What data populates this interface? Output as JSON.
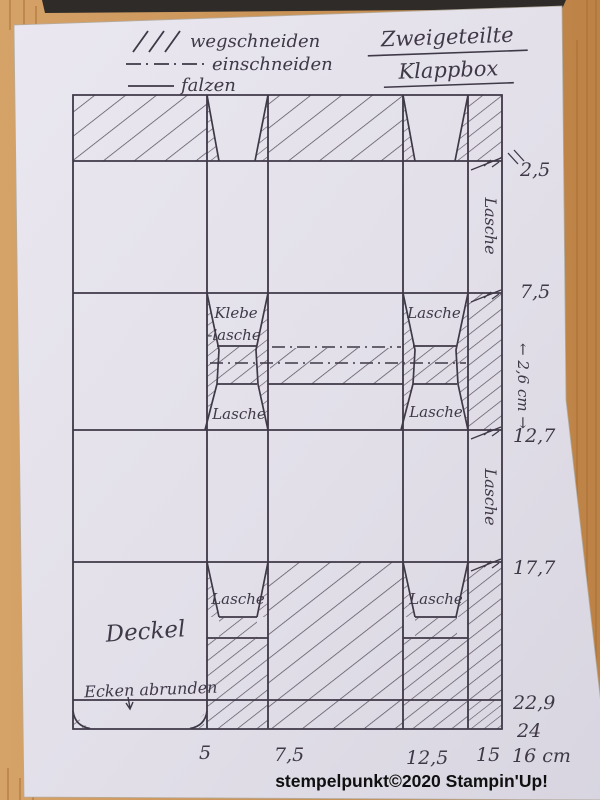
{
  "title": {
    "line1": "Zweigeteilte",
    "line2": "Klappbox"
  },
  "legend": {
    "items": [
      {
        "symbol": "hatch",
        "label": "wegschneiden"
      },
      {
        "symbol": "dash-dot",
        "label": "einschneiden"
      },
      {
        "symbol": "solid-line",
        "label": "falzen"
      }
    ]
  },
  "template": {
    "labels": {
      "klebe_line1": "Klebe",
      "klebe_line2": "-lasche",
      "lasche": "Lasche",
      "deckel": "Deckel",
      "round_corners": "Ecken abrunden",
      "slit_width_note": "← 2,6 cm →"
    },
    "right_scale": [
      "2,5",
      "7,5",
      "12,7",
      "17,7",
      "22,9",
      "24"
    ],
    "bottom_scale": [
      "5",
      "7,5",
      "12,5",
      "15",
      "16 cm"
    ]
  },
  "footer": {
    "credit": "stempelpunkt©2020 Stampin'Up!"
  },
  "colors": {
    "wood": "#c79055",
    "paper": "#e3e0ea",
    "ink": "#3f3847",
    "shadow": "#2f2b28"
  }
}
